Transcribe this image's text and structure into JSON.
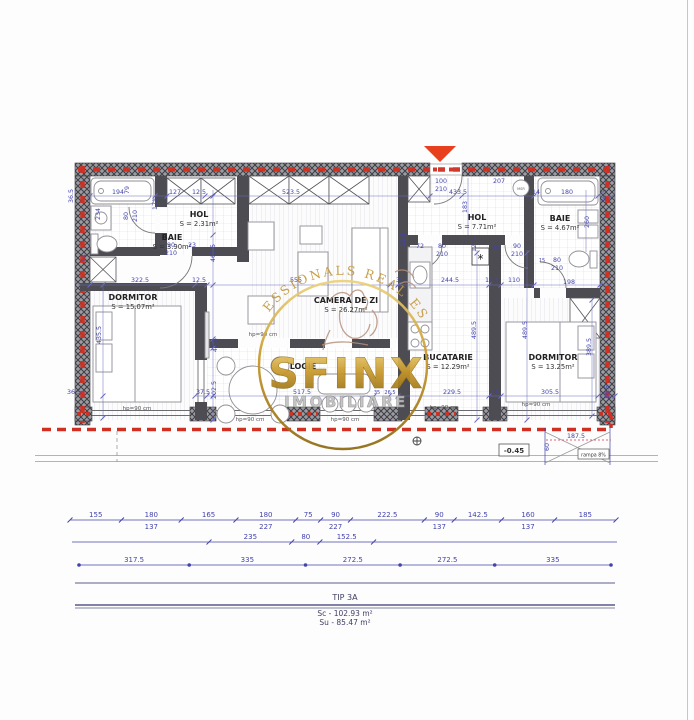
{
  "palette": {
    "dim_blue": "#4343ad",
    "red": "#d02f21",
    "wall_gray": "#55555c",
    "gold": "#c9992c",
    "marker_red": "#e8401c"
  },
  "rooms": [
    {
      "name": "BAIE",
      "area": "S = 3.90m²",
      "x": 172,
      "y": 240
    },
    {
      "name": "HOL",
      "area": "S = 2.31m²",
      "x": 199,
      "y": 217
    },
    {
      "name": "DORMITOR",
      "area": "S = 15.07m²",
      "x": 133,
      "y": 300
    },
    {
      "name": "CAMERA DE ZI",
      "area": "S = 26.27m²",
      "x": 346,
      "y": 303
    },
    {
      "name": "LOGIE",
      "area": "",
      "x": 303,
      "y": 369
    },
    {
      "name": "BUCATARIE",
      "area": "S = 12.29m²",
      "x": 448,
      "y": 360
    },
    {
      "name": "HOL",
      "area": "S = 7.71m²",
      "x": 477,
      "y": 220
    },
    {
      "name": "BAIE",
      "area": "S = 4.67m²",
      "x": 560,
      "y": 221
    },
    {
      "name": "DORMITOR",
      "area": "S = 13.25m²",
      "x": 553,
      "y": 360
    }
  ],
  "plan_dims": [
    {
      "t": "194",
      "x": 118,
      "y": 194
    },
    {
      "t": "79",
      "x": 129,
      "y": 190,
      "r": -90
    },
    {
      "t": "127",
      "x": 175,
      "y": 194
    },
    {
      "t": "12.5",
      "x": 199,
      "y": 194
    },
    {
      "t": "523.5",
      "x": 291,
      "y": 194
    },
    {
      "t": "36.5",
      "x": 73,
      "y": 196,
      "r": -90
    },
    {
      "t": "171",
      "x": 157,
      "y": 204,
      "r": -90
    },
    {
      "t": "234",
      "x": 100,
      "y": 214,
      "r": -90
    },
    {
      "t": "80",
      "x": 128,
      "y": 216,
      "r": -90
    },
    {
      "t": "210",
      "x": 137,
      "y": 216,
      "r": -90
    },
    {
      "t": "14",
      "x": 86,
      "y": 258,
      "r": -90
    },
    {
      "t": "90",
      "x": 171,
      "y": 247
    },
    {
      "t": "210",
      "x": 171,
      "y": 255
    },
    {
      "t": "23",
      "x": 192,
      "y": 247
    },
    {
      "t": "467.5",
      "x": 215,
      "y": 253,
      "r": -90
    },
    {
      "t": "322.5",
      "x": 140,
      "y": 282
    },
    {
      "t": "12.5",
      "x": 199,
      "y": 282
    },
    {
      "t": "555",
      "x": 296,
      "y": 282
    },
    {
      "t": "35",
      "x": 400,
      "y": 282
    },
    {
      "t": "244.5",
      "x": 450,
      "y": 282
    },
    {
      "t": "12.5",
      "x": 492,
      "y": 282
    },
    {
      "t": "110",
      "x": 514,
      "y": 282
    },
    {
      "t": "198",
      "x": 569,
      "y": 284
    },
    {
      "t": "435.5",
      "x": 101,
      "y": 335,
      "r": -90
    },
    {
      "t": "36.5",
      "x": 74,
      "y": 394
    },
    {
      "t": "47.5",
      "x": 217,
      "y": 345,
      "r": -90
    },
    {
      "t": "202.5",
      "x": 216,
      "y": 390,
      "r": -90
    },
    {
      "t": "37.5",
      "x": 203,
      "y": 394
    },
    {
      "t": "517.5",
      "x": 302,
      "y": 394
    },
    {
      "t": "35",
      "x": 377,
      "y": 394,
      "s": 5
    },
    {
      "t": "26.5",
      "x": 390,
      "y": 394,
      "s": 5
    },
    {
      "t": "229.5",
      "x": 452,
      "y": 394
    },
    {
      "t": "14",
      "x": 495,
      "y": 394
    },
    {
      "t": "305.5",
      "x": 550,
      "y": 394
    },
    {
      "t": "36.5",
      "x": 609,
      "y": 392,
      "r": -90
    },
    {
      "t": "489.5",
      "x": 476,
      "y": 330,
      "r": -90
    },
    {
      "t": "489.5",
      "x": 527,
      "y": 330,
      "r": -90
    },
    {
      "t": "389.5",
      "x": 591,
      "y": 347,
      "r": -90
    },
    {
      "t": "100",
      "x": 441,
      "y": 183
    },
    {
      "t": "210",
      "x": 441,
      "y": 191
    },
    {
      "t": "433.5",
      "x": 458,
      "y": 194
    },
    {
      "t": "207",
      "x": 499,
      "y": 183
    },
    {
      "t": "14",
      "x": 536,
      "y": 194
    },
    {
      "t": "180",
      "x": 567,
      "y": 194
    },
    {
      "t": "36.5",
      "x": 606,
      "y": 196,
      "r": -90
    },
    {
      "t": "183",
      "x": 467,
      "y": 207,
      "r": -90
    },
    {
      "t": "12.5",
      "x": 476,
      "y": 245,
      "r": -90
    },
    {
      "t": "72",
      "x": 420,
      "y": 248
    },
    {
      "t": "80",
      "x": 442,
      "y": 248
    },
    {
      "t": "210",
      "x": 442,
      "y": 256
    },
    {
      "t": "16",
      "x": 496,
      "y": 250,
      "s": 5
    },
    {
      "t": "90",
      "x": 517,
      "y": 248
    },
    {
      "t": "210",
      "x": 517,
      "y": 256
    },
    {
      "t": "15",
      "x": 542,
      "y": 262,
      "s": 5
    },
    {
      "t": "80",
      "x": 557,
      "y": 262
    },
    {
      "t": "210",
      "x": 557,
      "y": 270
    },
    {
      "t": "260",
      "x": 589,
      "y": 222,
      "r": -90
    },
    {
      "t": "12.5",
      "x": 405,
      "y": 240,
      "r": -90
    },
    {
      "t": "187.5",
      "x": 576,
      "y": 438
    },
    {
      "t": "60",
      "x": 549,
      "y": 447,
      "r": -90
    }
  ],
  "annotations": {
    "hp_text": "hp=90 cm",
    "hp_positions": [
      [
        137,
        410
      ],
      [
        250,
        421
      ],
      [
        345,
        421
      ],
      [
        444,
        409
      ],
      [
        536,
        406
      ],
      [
        263,
        336
      ]
    ],
    "level": "-0.45",
    "ramp": "rampa 8%",
    "washer": "MSR",
    "star": "*"
  },
  "dim_rows": {
    "row1": {
      "segments": [
        {
          "v": "155"
        },
        {
          "v": "180",
          "u": "137"
        },
        {
          "v": "165"
        },
        {
          "v": "180",
          "u": "227"
        },
        {
          "v": "75"
        },
        {
          "v": "90",
          "u": "227"
        },
        {
          "v": "222.5"
        },
        {
          "v": "90",
          "u": "137"
        },
        {
          "v": "142.5"
        },
        {
          "v": "160",
          "u": "137"
        },
        {
          "v": "185"
        }
      ]
    },
    "row2": {
      "segments": [
        {
          "v": "235"
        },
        {
          "v": "80"
        },
        {
          "v": "152.5"
        }
      ]
    },
    "row3": {
      "segments": [
        {
          "v": "317.5"
        },
        {
          "v": "335"
        },
        {
          "v": "272.5"
        },
        {
          "v": "272.5"
        },
        {
          "v": "335"
        }
      ]
    }
  },
  "title_block": {
    "type": "TIP 3A",
    "sc": "Sc - 102.93 m²",
    "su": "Su - 85.47 m²"
  },
  "watermark": {
    "arc_text": "PROFESSIONALS REAL ESTATE",
    "brand": "SFINX",
    "sub": "IMOBILIARE"
  }
}
